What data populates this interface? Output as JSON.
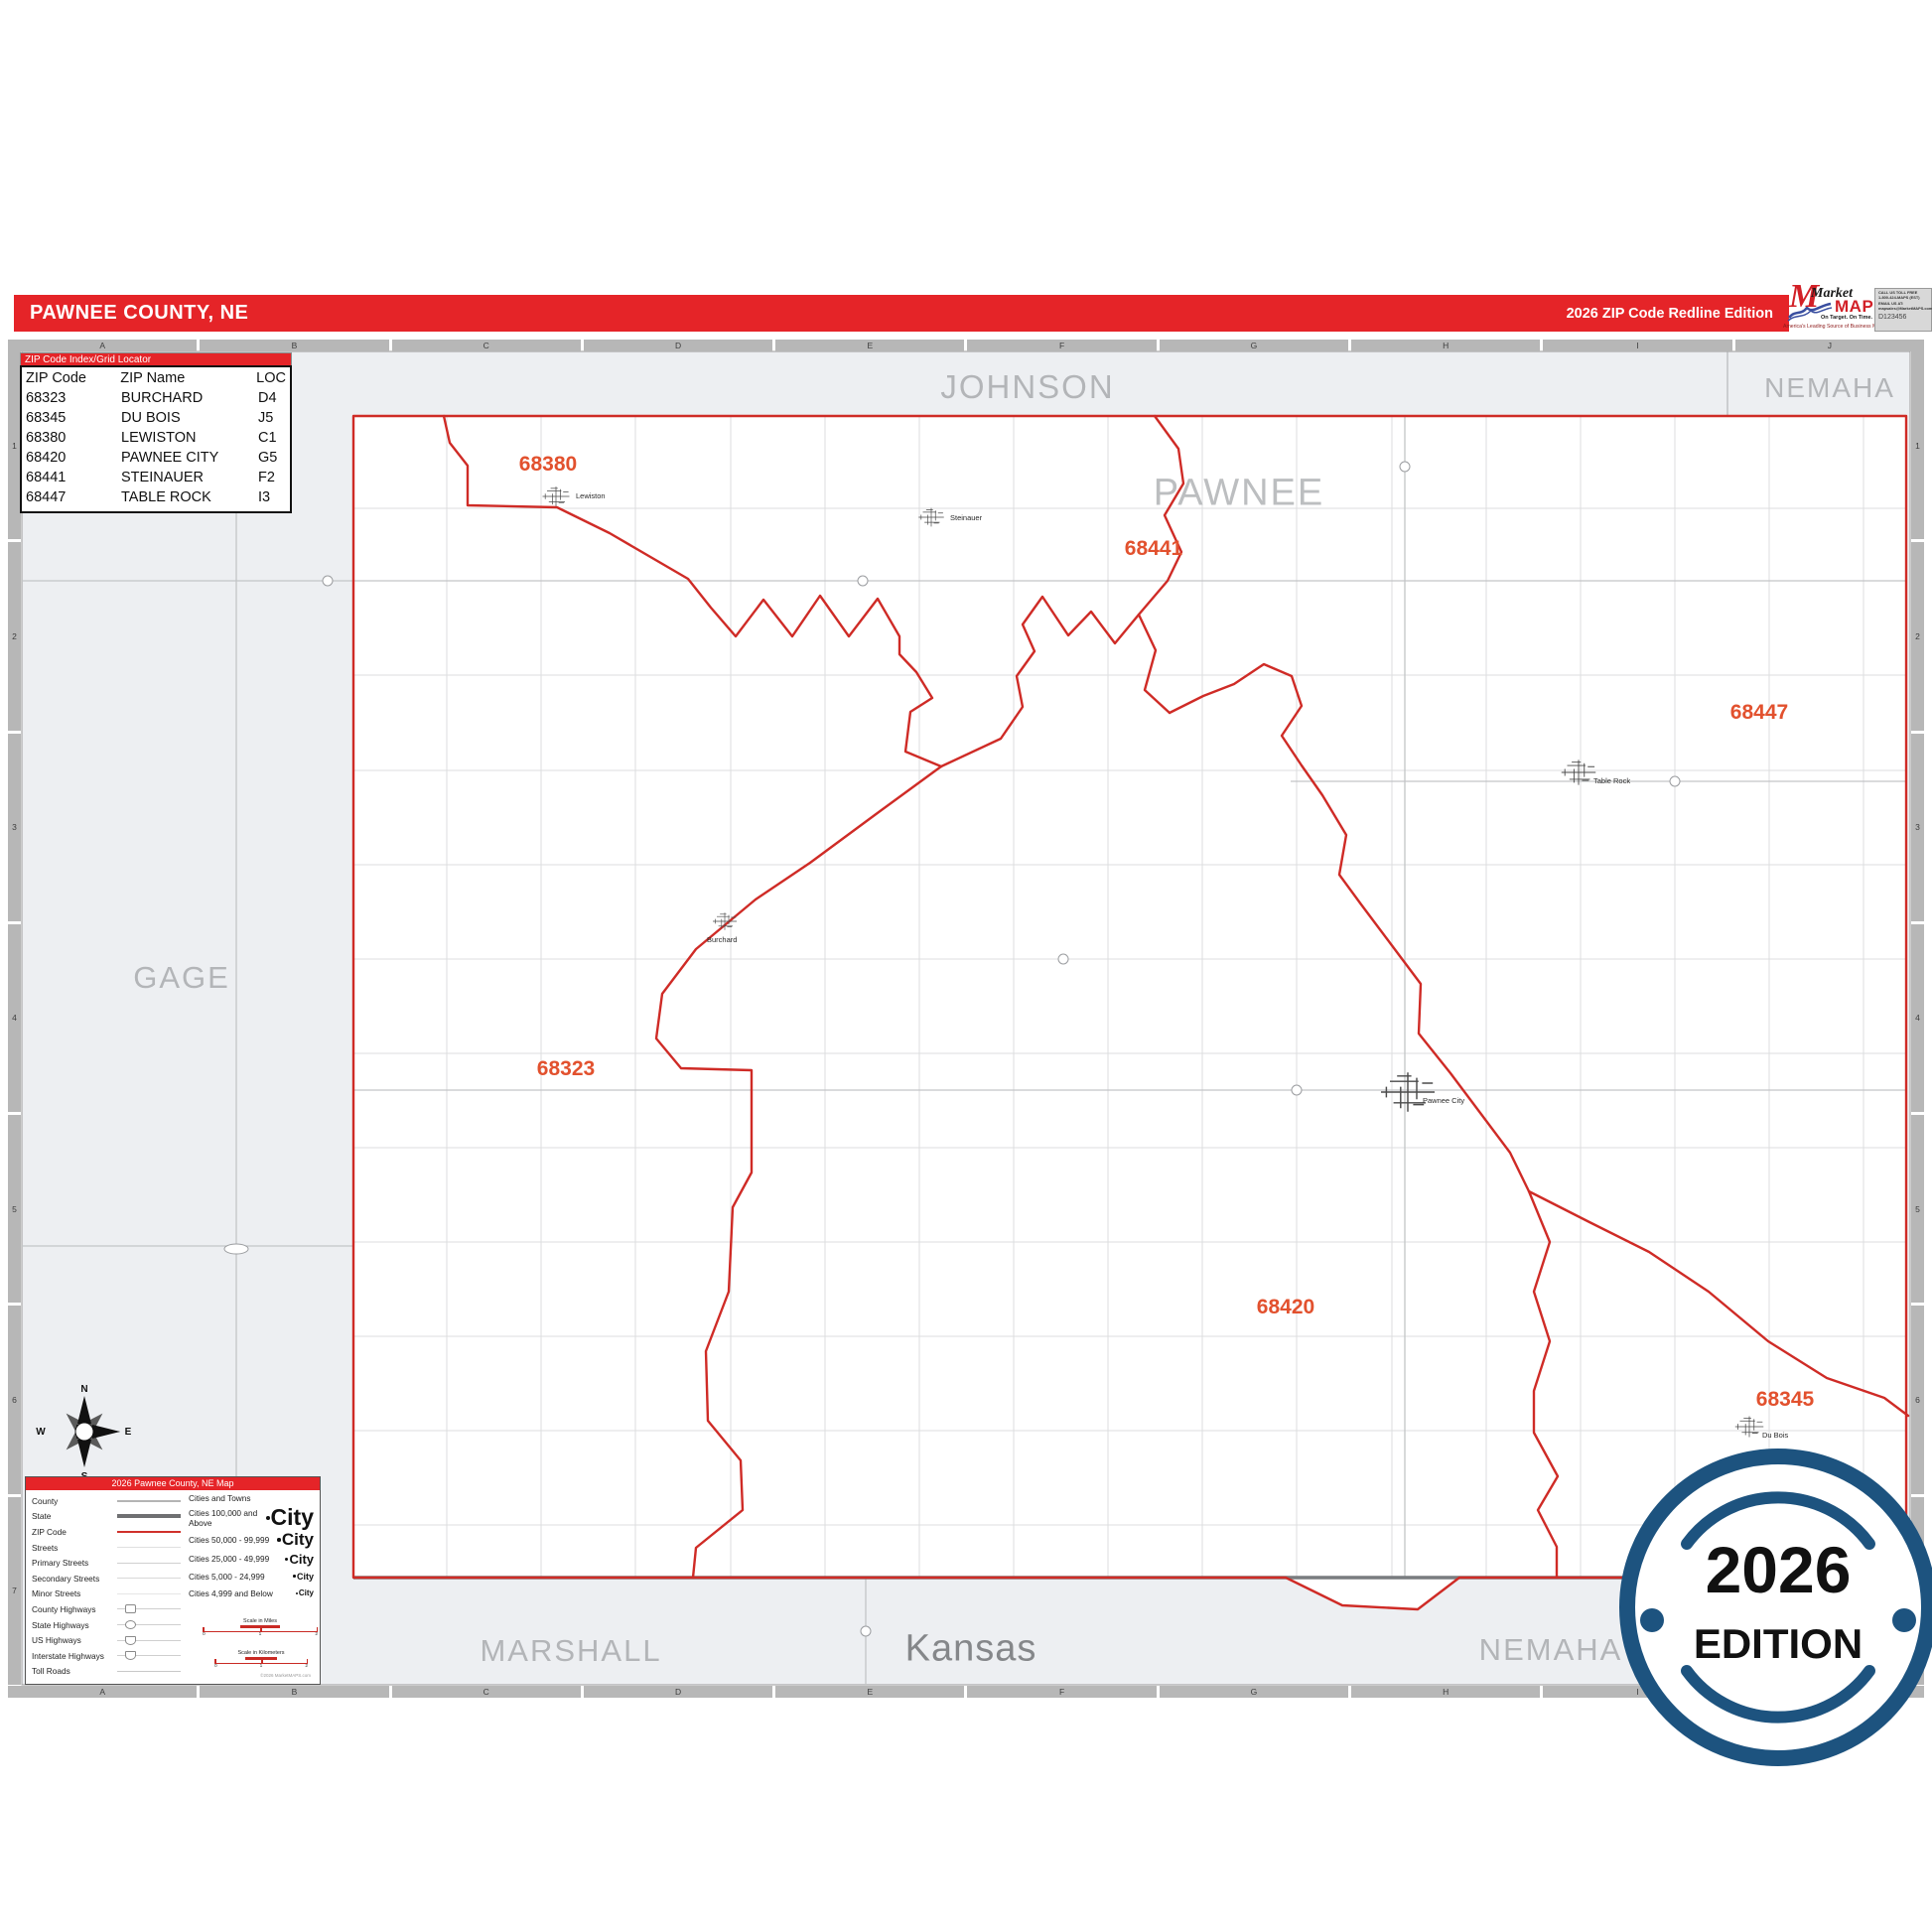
{
  "header": {
    "title": "PAWNEE COUNTY, NE",
    "edition": "2026 ZIP Code Redline Edition"
  },
  "logo": {
    "market": "Market",
    "maps": "MAPS",
    "tagline": "On Target.  On Time.",
    "subtitle": "America's Leading Source of Business Maps",
    "contact": [
      "CALL US TOLL FREE",
      "1-800-424-MAPS (EST)",
      "EMAIL US AT:",
      "mapsales@MarketMAPS.com"
    ],
    "code": "D123456"
  },
  "grid": {
    "cols": [
      "A",
      "B",
      "C",
      "D",
      "E",
      "F",
      "G",
      "H",
      "I",
      "J"
    ],
    "rows": [
      "1",
      "2",
      "3",
      "4",
      "5",
      "6",
      "7"
    ]
  },
  "zip_index": {
    "title": "ZIP Code Index/Grid Locator",
    "columns": [
      "ZIP Code",
      "ZIP Name",
      "LOC"
    ],
    "rows": [
      {
        "code": "68323",
        "name": "BURCHARD",
        "loc": "D4"
      },
      {
        "code": "68345",
        "name": "DU BOIS",
        "loc": "J5"
      },
      {
        "code": "68380",
        "name": "LEWISTON",
        "loc": "C1"
      },
      {
        "code": "68420",
        "name": "PAWNEE CITY",
        "loc": "G5"
      },
      {
        "code": "68441",
        "name": "STEINAUER",
        "loc": "F2"
      },
      {
        "code": "68447",
        "name": "TABLE ROCK",
        "loc": "I3"
      }
    ]
  },
  "neighbors": {
    "johnson": "JOHNSON",
    "nemaha_top": "NEMAHA",
    "gage": "GAGE",
    "marshall": "MARSHALL",
    "kansas": "Kansas",
    "nemaha_bottom": "NEMAHA",
    "county": "PAWNEE"
  },
  "zip_labels": [
    {
      "code": "68380"
    },
    {
      "code": "68441"
    },
    {
      "code": "68447"
    },
    {
      "code": "68323"
    },
    {
      "code": "68420"
    },
    {
      "code": "68345"
    }
  ],
  "towns": [
    {
      "name": "Lewiston"
    },
    {
      "name": "Steinauer"
    },
    {
      "name": "Burchard"
    },
    {
      "name": "Table Rock"
    },
    {
      "name": "Pawnee City"
    },
    {
      "name": "Du Bois"
    }
  ],
  "compass": {
    "n": "N",
    "e": "E",
    "s": "S",
    "w": "W"
  },
  "legend": {
    "title": "2026 Pawnee County, NE Map",
    "line_items": [
      {
        "label": "County"
      },
      {
        "label": "State"
      },
      {
        "label": "ZIP Code"
      },
      {
        "label": "Streets"
      },
      {
        "label": "Primary Streets"
      },
      {
        "label": "Secondary Streets"
      },
      {
        "label": "Minor Streets"
      },
      {
        "label": "County Highways"
      },
      {
        "label": "State Highways"
      },
      {
        "label": "US Highways"
      },
      {
        "label": "Interstate Highways"
      },
      {
        "label": "Toll Roads"
      }
    ],
    "cities_header": "Cities and Towns",
    "city_classes": [
      {
        "label": "Cities 100,000 and Above",
        "sample": "City"
      },
      {
        "label": "Cities 50,000 - 99,999",
        "sample": "City"
      },
      {
        "label": "Cities 25,000 - 49,999",
        "sample": "City"
      },
      {
        "label": "Cities 5,000 - 24,999",
        "sample": "City"
      },
      {
        "label": "Cities 4,999 and Below",
        "sample": "City"
      }
    ],
    "scale_miles": "Scale in Miles",
    "scale_km": "Scale in Kilometers",
    "ticks": [
      "0",
      "1",
      "2"
    ],
    "fine_print": "©2026 MarketMAPS.com"
  },
  "badge": {
    "year": "2026",
    "edition": "EDITION"
  }
}
